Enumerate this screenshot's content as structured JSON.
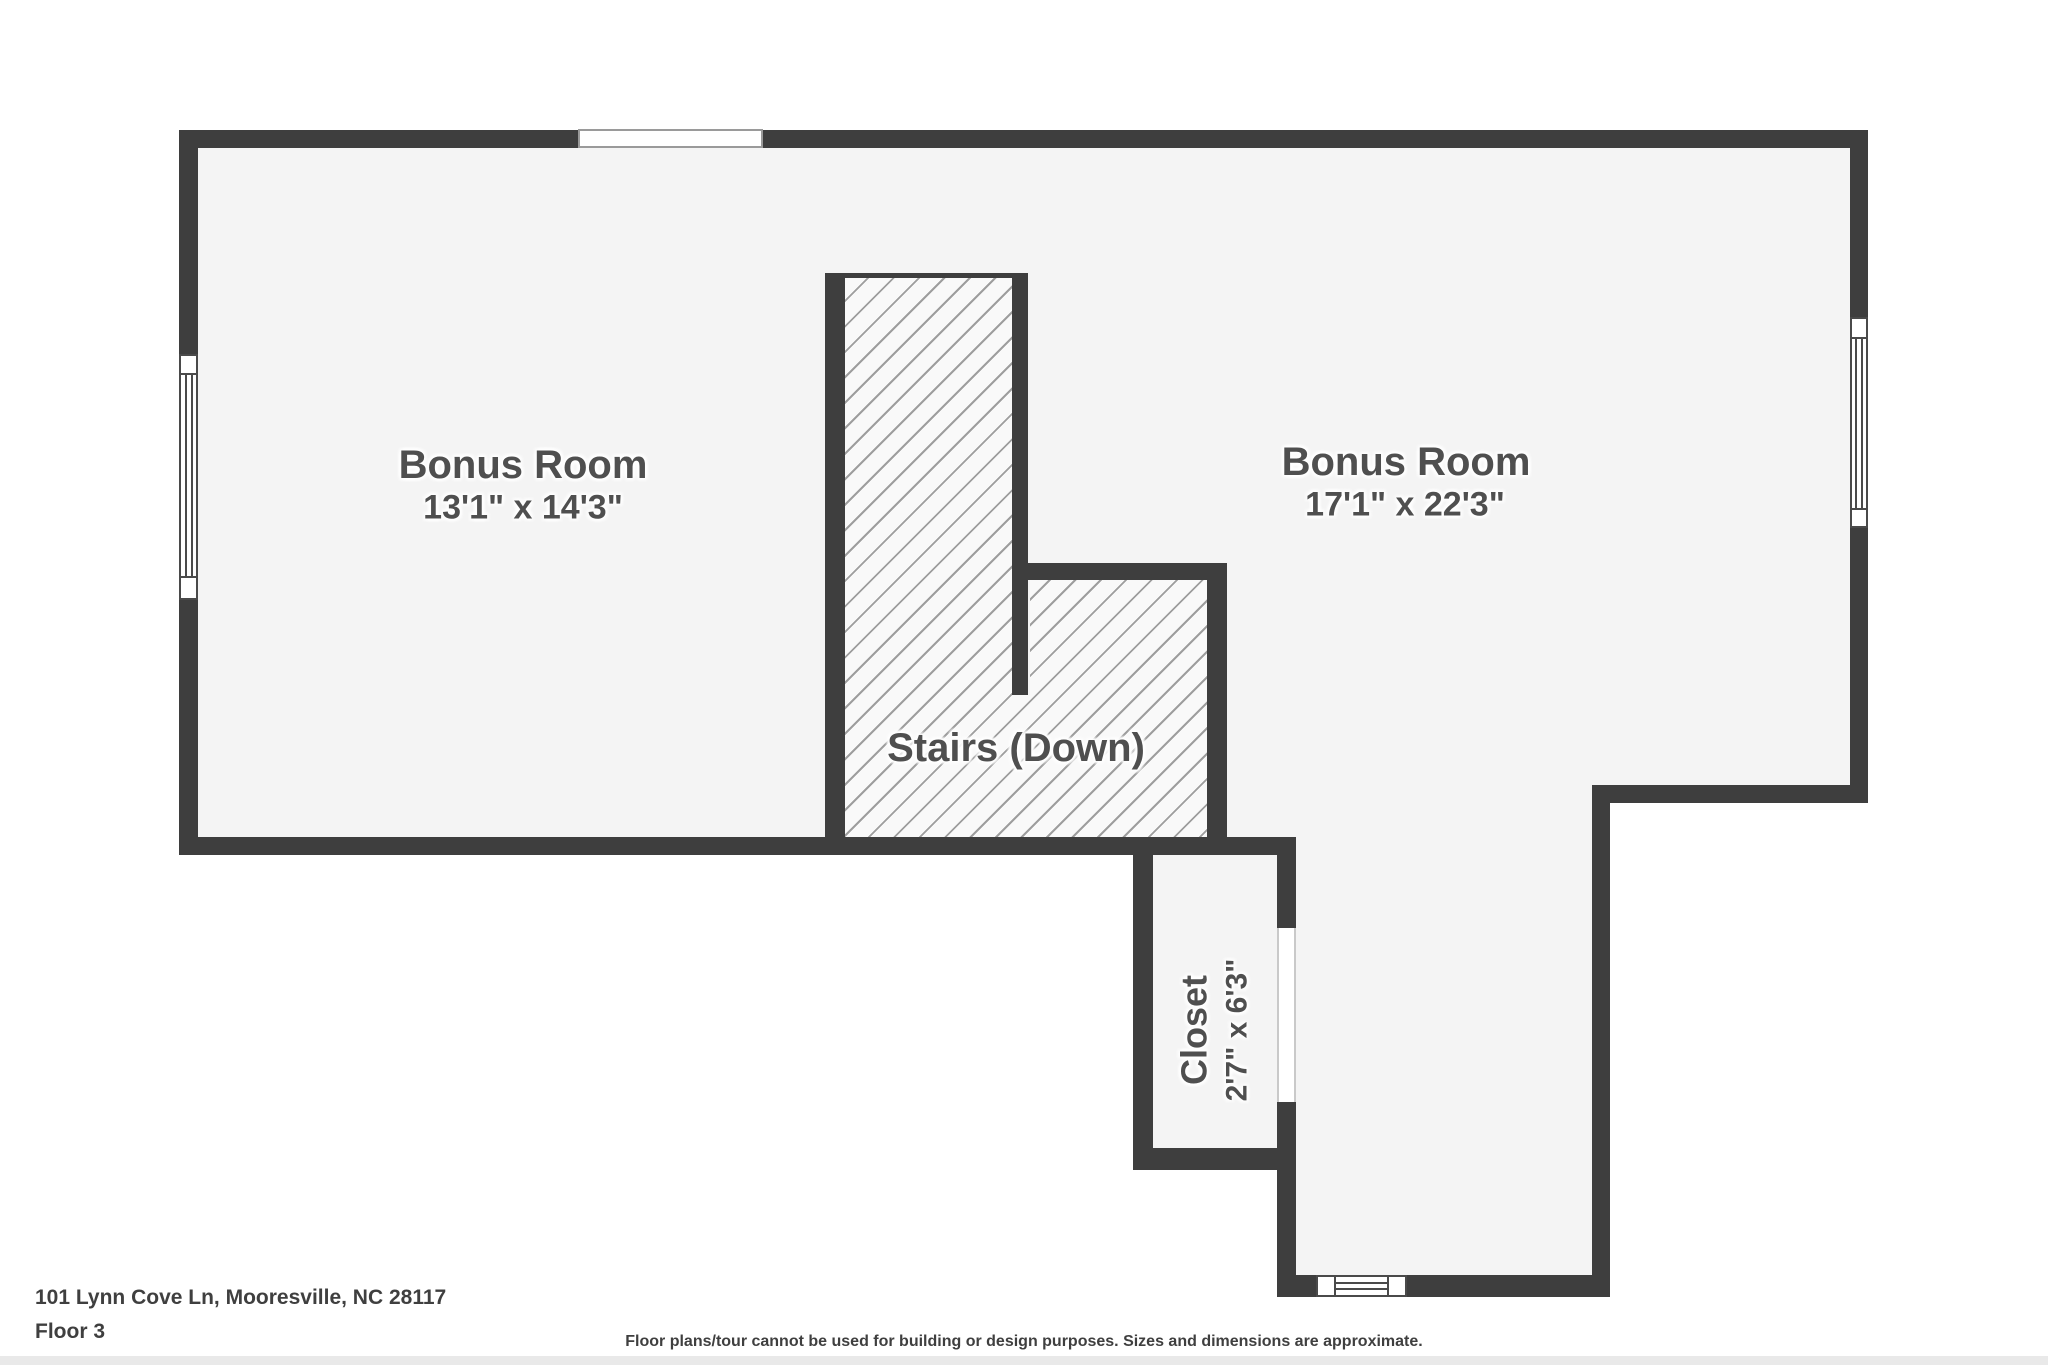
{
  "palette": {
    "background": "#ffffff",
    "wall": "#3e3e3e",
    "floor": "#f4f4f4",
    "hatch_background": "#f9f9f9",
    "hatch_line": "#9e9e9e",
    "window_line": "#4a4a4a",
    "room_label": "#4f4f4f",
    "footer_text": "#3f3f3f",
    "bottom_strip": "#e9e9e9"
  },
  "rooms": {
    "bonus_left": {
      "name": "Bonus Room",
      "dimensions": "13'1\" x 14'3\""
    },
    "bonus_right": {
      "name": "Bonus Room",
      "dimensions": "17'1\" x 22'3\""
    },
    "stairs": {
      "name": "Stairs (Down)"
    },
    "closet": {
      "name": "Closet",
      "dimensions": "2'7\" x 6'3\""
    }
  },
  "footer": {
    "address": "101 Lynn Cove Ln, Mooresville, NC 28117",
    "floor_label": "Floor 3",
    "disclaimer": "Floor plans/tour cannot be used for building or design purposes. Sizes and dimensions are approximate."
  }
}
